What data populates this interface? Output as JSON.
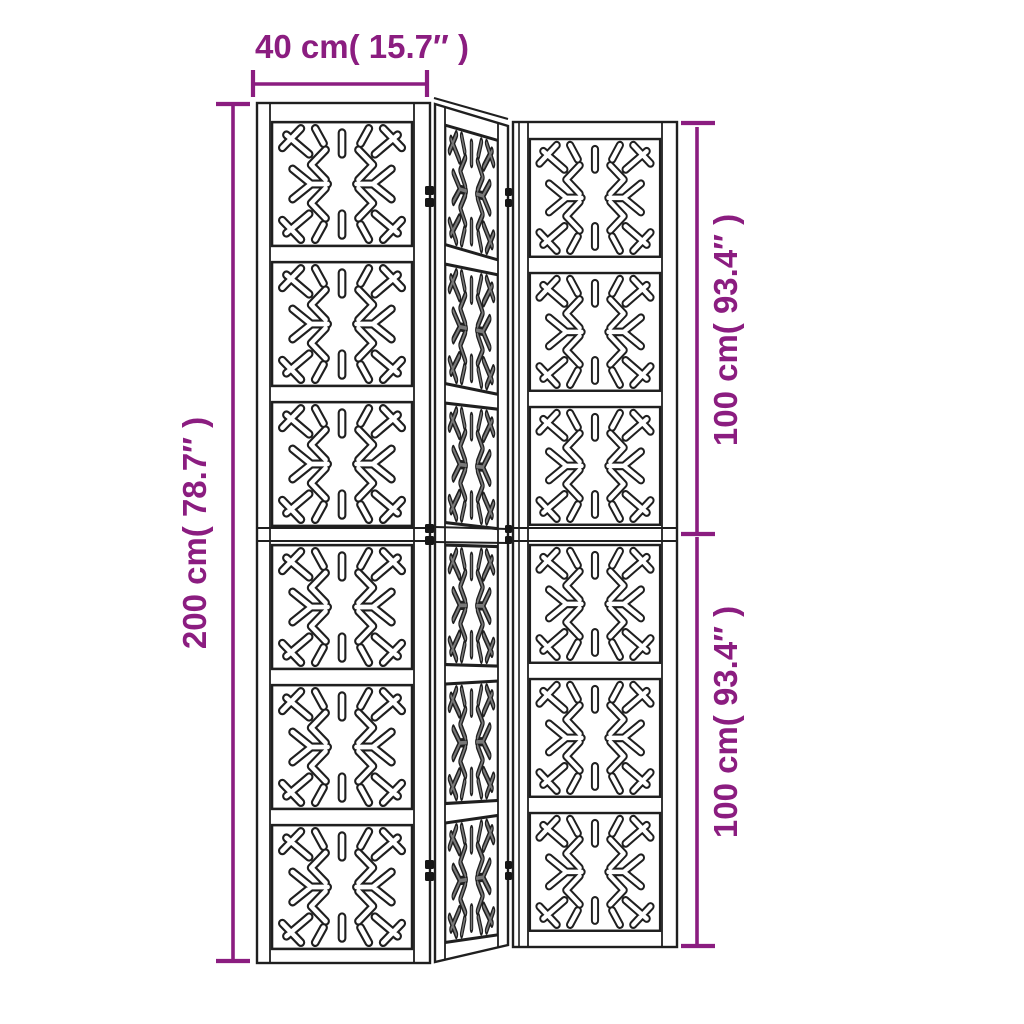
{
  "page": {
    "background": "#ffffff"
  },
  "diagram": {
    "title": "Room divider 3-panel dimension diagram",
    "line_color": "#1f1f1f",
    "accent_color": "#8B1D80",
    "labels": {
      "width": "40 cm( 15.7″ )",
      "height": "200 cm( 78.7″ )",
      "panel_upper": "100 cm( 93.4″ )",
      "panel_lower": "100 cm( 93.4″ )"
    }
  }
}
